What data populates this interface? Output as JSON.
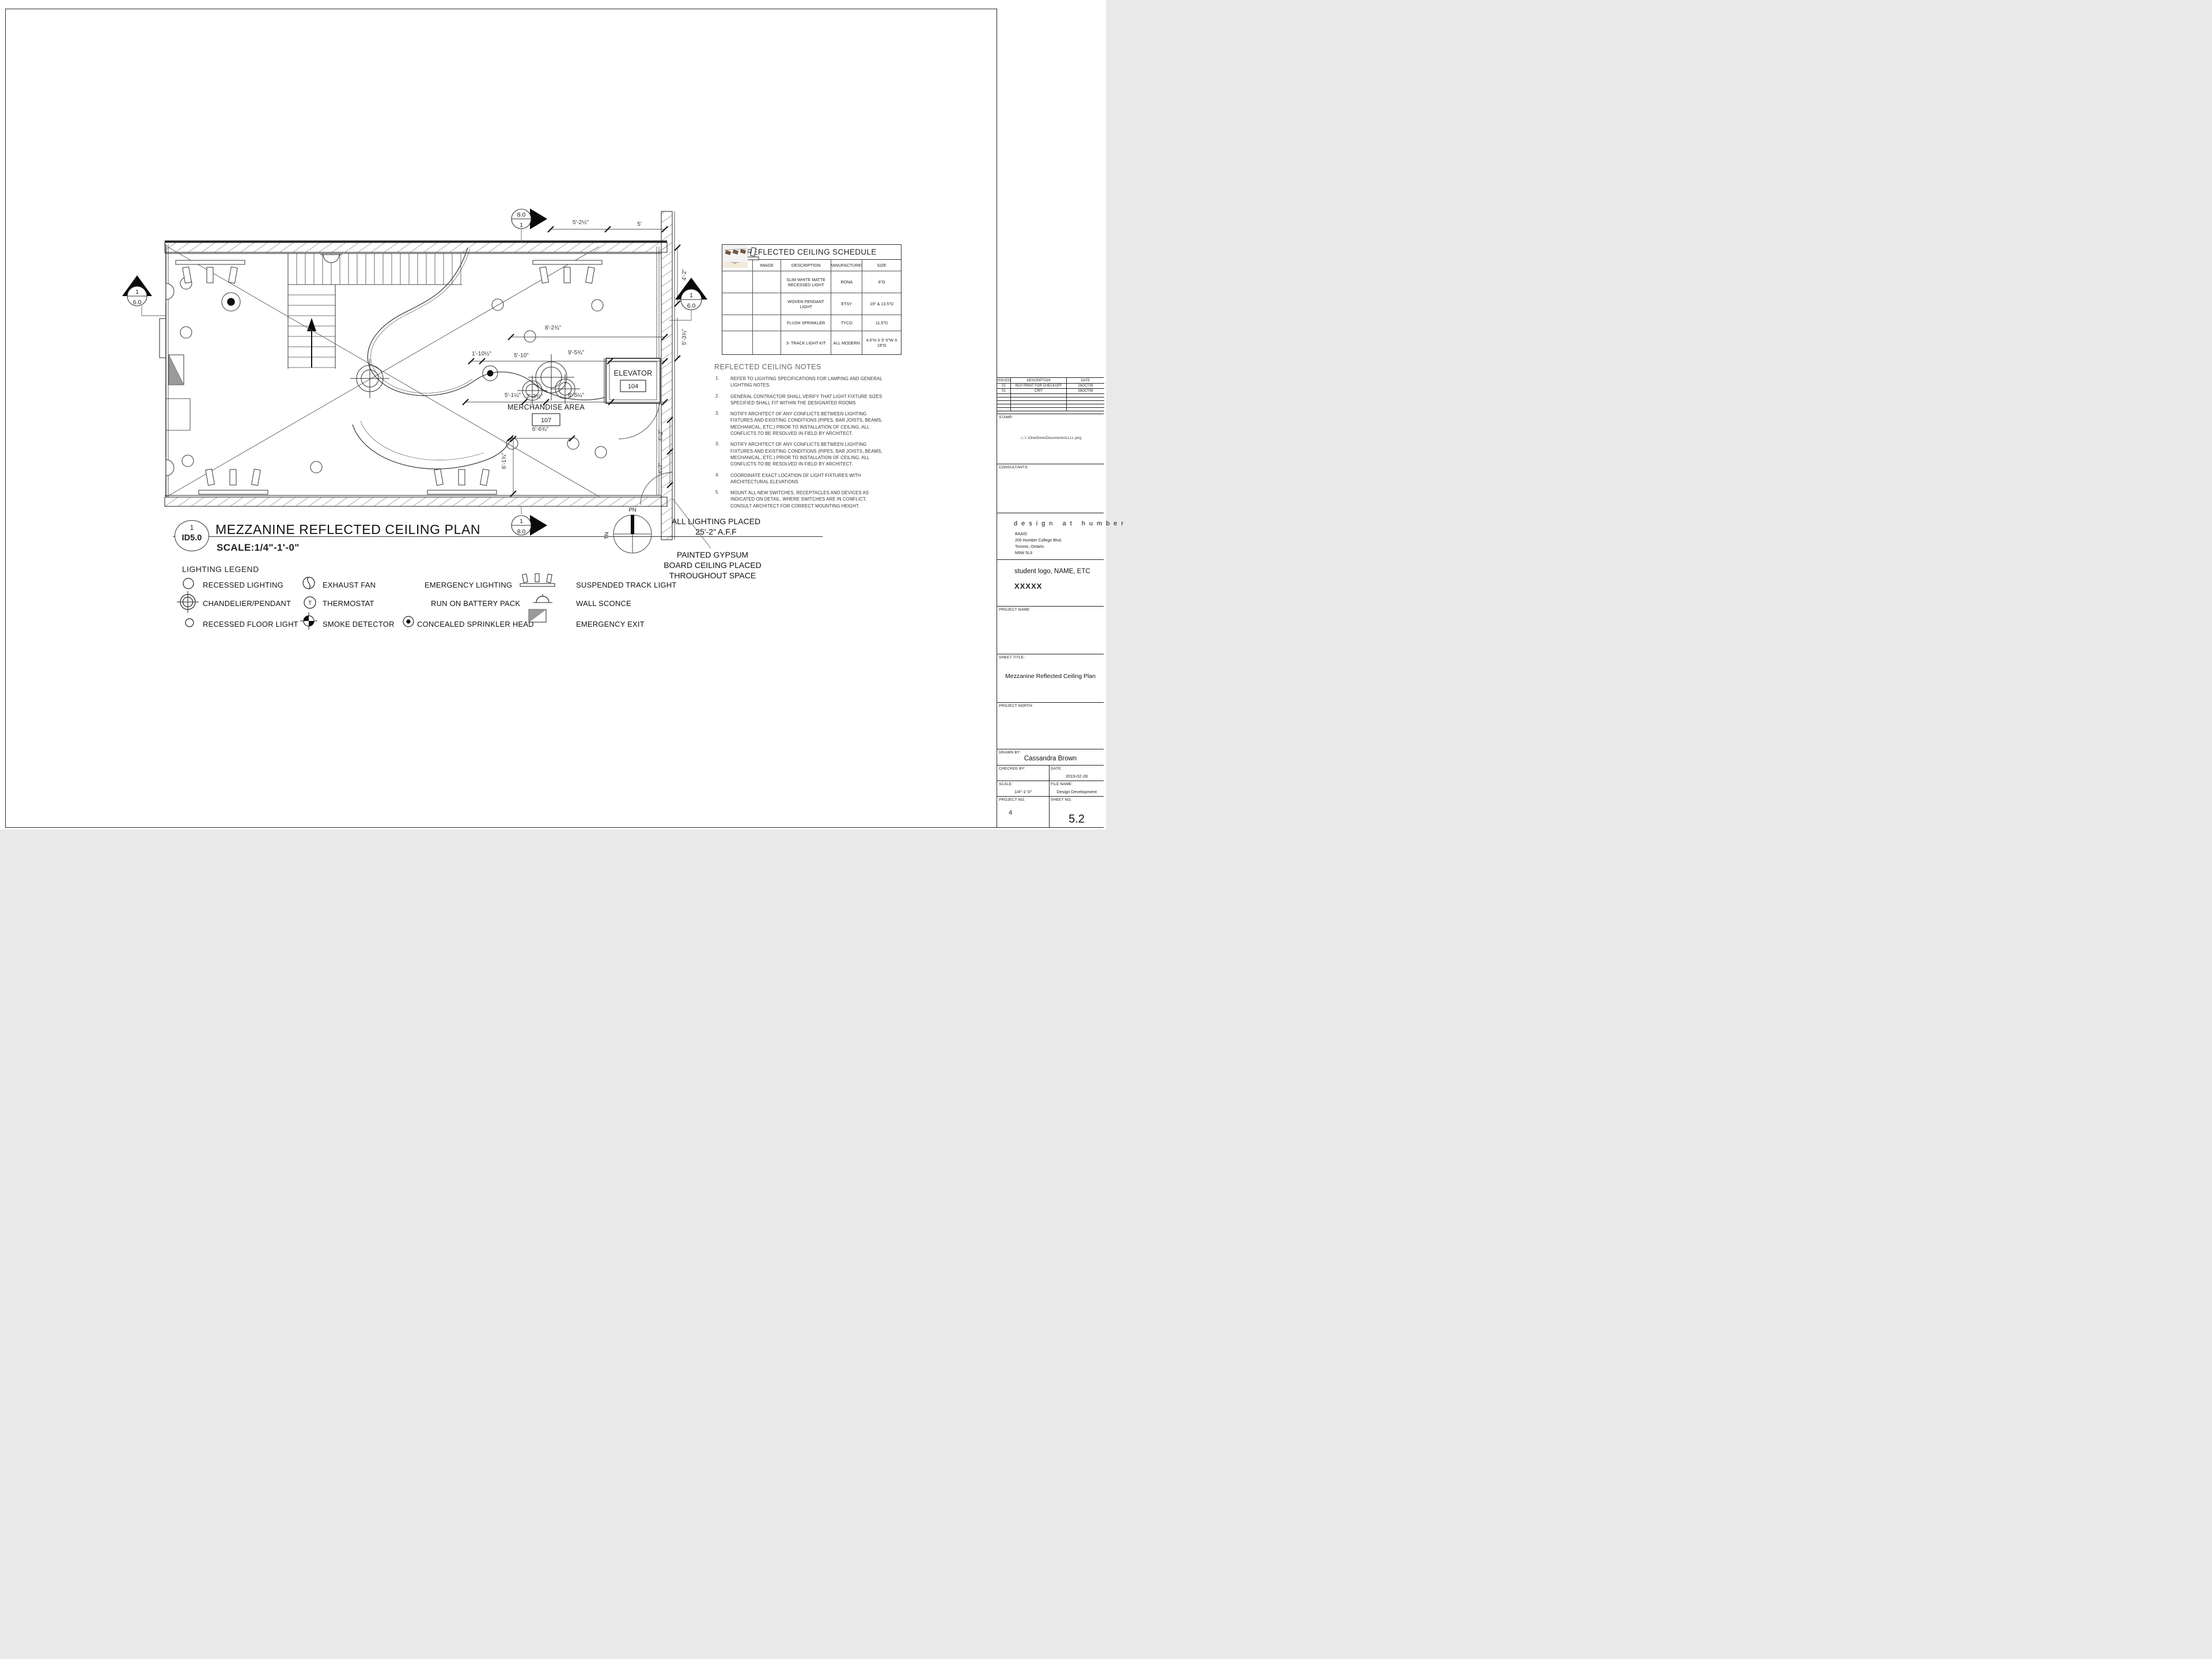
{
  "plan_header": {
    "detail_no": "1",
    "detail_ref": "ID5.0",
    "title": "MEZZANINE REFLECTED CEILING PLAN",
    "scale": "SCALE:1/4\"-1'-0\""
  },
  "plan": {
    "rooms": {
      "elevator": "ELEVATOR",
      "elevator_tag": "104",
      "merch": "MERCHANDISE AREA",
      "merch_tag": "107"
    },
    "dims": [
      "5'-2½\"",
      "5'",
      "4'-2\"",
      "5'-3¾\"",
      "8'-2¾\"",
      "1'-10½\"",
      "5'-10\"",
      "9'-5¾\"",
      "5'-1¼\"",
      "2'-3½\"",
      "8'-5¼\"",
      "6'-6¾\"",
      "6'-1¾\"",
      "4'-2\"",
      "4'-7\""
    ],
    "markers": {
      "sec_top_a": "8.0",
      "sec_top_b": "1",
      "sec_bot_a": "1",
      "sec_bot_b": "8.0",
      "elev_left_a": "1",
      "elev_left_b": "6.0",
      "elev_right_a": "1",
      "elev_right_b": "6.0"
    },
    "compass": {
      "pn": "PN",
      "tn": "TN"
    },
    "ann": {
      "l1": "ALL LIGHTING  PLACED",
      "l2": "25'-2\" A.F.F",
      "g1": "PAINTED GYPSUM",
      "g2": "BOARD CEILING PLACED",
      "g3": "THROUGHOUT SPACE"
    }
  },
  "legend": {
    "title": "LIGHTING LEGEND",
    "thermostat_glyph": "T",
    "items": [
      {
        "label": "RECESSED LIGHTING",
        "symbol": "circle"
      },
      {
        "label": "CHANDELIER/PENDANT",
        "symbol": "pendant"
      },
      {
        "label": "RECESSED FLOOR LIGHT",
        "symbol": "circle-small"
      },
      {
        "label": "EXHAUST FAN",
        "symbol": "fan"
      },
      {
        "label": "THERMOSTAT",
        "symbol": "thermostat"
      },
      {
        "label": "SMOKE DETECTOR",
        "symbol": "smoke"
      },
      {
        "label": "EMERGENCY LIGHTING",
        "symbol": "none"
      },
      {
        "label": "RUN ON BATTERY PACK",
        "symbol": "none"
      },
      {
        "label": "CONCEALED SPRINKLER HEAD",
        "symbol": "sprinkler"
      },
      {
        "label": "SUSPENDED TRACK LIGHT",
        "symbol": "track"
      },
      {
        "label": "WALL SCONCE",
        "symbol": "sconce"
      },
      {
        "label": "EMERGENCY EXIT",
        "symbol": "exit"
      }
    ]
  },
  "schedule": {
    "title": "REFLECTED CEILING SCHEDULE",
    "columns": [
      "SYMBOL",
      "IMAGE",
      "DESCRIPTION",
      "MANUFACTURER",
      "SIZE"
    ],
    "rows": [
      {
        "symbol": "circle",
        "image": "recessed-light-photo",
        "description": "SLIM WHITE MATTE RECESSED LIGHT",
        "manufacturer": "RONA",
        "size": "6\"D"
      },
      {
        "symbol": "pendant",
        "image": "woven-pendant-photo",
        "description": "WOVEN PENDANT LIGHT",
        "manufacturer": "ETSY",
        "size": "19\" & 13.5\"D"
      },
      {
        "symbol": "sprinkler",
        "image": "flush-sprinkler-photo",
        "description": "FLUSH SPRINKLER",
        "manufacturer": "TYCO",
        "size": "11.5\"D"
      },
      {
        "symbol": "track",
        "image": "track-light-photo",
        "description": "3- TRACK LIGHT KIT",
        "manufacturer": "ALL MODERN",
        "size": "4.5\"H X 5'-5\"W X 18\"D"
      }
    ]
  },
  "notes": {
    "title": "REFLECTED CEILING NOTES",
    "items": [
      {
        "n": "1.",
        "t": "REFER TO LIGHTING SPECIFICATIONS FOR LAMPING AND GENERAL LIGHTING NOTES."
      },
      {
        "n": "2.",
        "t": "GENERAL CONTRACTOR SHALL VERIFY THAT LIGHT FIXTURE SIZES SPECIFIED SHALL FIT WITHIN THE DESIGNATED ROOMS"
      },
      {
        "n": "3.",
        "t": "NOTIFY ARCHITECT OF ANY CONFLICTS BETWEEN LIGHTING FIXTURES AND EXISTING CONDITIONS (PIPES, BAR JOISTS, BEAMS, MECHANICAL, ETC.) PRIOR TO INSTALLATION OF CEILING. ALL CONFLICTS TO BE RESOLVED IN FIELD BY ARCHITECT."
      },
      {
        "n": "3.",
        "t": "NOTIFY ARCHITECT OF ANY CONFLICTS BETWEEN LIGHTING FIXTURES AND EXISTING CONDITIONS (PIPES, BAR JOISTS, BEAMS, MECHANICAL, ETC.) PRIOR TO INSTALLATION OF CEILING. ALL CONFLICTS TO BE RESOLVED IN FIELD BY ARCHITECT."
      },
      {
        "n": "4.",
        "t": "COORDINATE EXACT LOCATION OF LIGHT FIXTURES WITH ARCHITECTURAL ELEVATIONS"
      },
      {
        "n": "5.",
        "t": "MOUNT ALL NEW SWITCHES, RECEPTACLES AND DEVICES AS INDICATED ON DETAIL. WHERE SWITCHES ARE IN CONFLICT, CONSULT ARCHITECT FOR CORRECT MOUNTING HEIGHT."
      }
    ]
  },
  "titleblock": {
    "issued": {
      "headers": [
        "ISSUED",
        "DESCRIPTION",
        "DATE"
      ],
      "rows": [
        [
          "02",
          "RCP PRINT FOR CHECKOFF",
          "29OCT09"
        ],
        [
          "01",
          "CRIT",
          "28OCT09"
        ]
      ]
    },
    "stamp_label": "STAMP:",
    "stamp_path": "..\\..\\..\\OneDrive\\Documents\\LLLL.png",
    "consultants_label": "CONSULTANTS:",
    "firm_name": "design at humber",
    "firm_addr1": "BAAID",
    "firm_addr2": "205 Humber College Blvd.",
    "firm_addr3": "Toronto, Ontario",
    "firm_addr4": "M9W 5L9",
    "student_line1": "student logo, NAME, ETC",
    "student_line2": "XXXXX",
    "project_name_label": "PROJECT NAME:",
    "sheet_title_label": "SHEET TITLE:",
    "sheet_title": "Mezzanine Reflected Ceiling Plan",
    "project_north_label": "PROJECT NORTH:",
    "drawn_by_label": "DRAWN BY:",
    "drawn_by": "Cassandra Brown",
    "checked_by_label": "CHECKED BY:",
    "date_label": "DATE:",
    "date": "2019-02-28",
    "scale_label": "SCALE:",
    "scale": "1/4\"-1'-0\"",
    "file_name_label": "FILE NAME:",
    "file_name": "Design Development",
    "project_no_label": "PROJECT NO.",
    "project_no": "4",
    "sheet_no_label": "SHEET NO.",
    "sheet_no": "5.2"
  }
}
